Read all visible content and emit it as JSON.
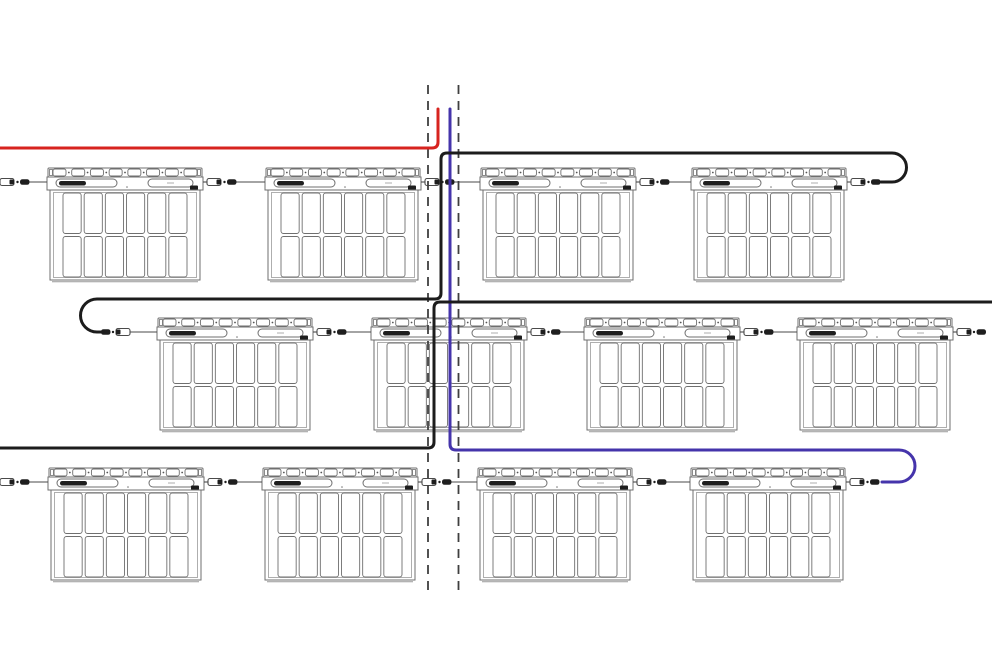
{
  "diagram": {
    "type": "solar-pv-string-wiring-diagram",
    "canvas": {
      "width": 992,
      "height": 650,
      "background": "#ffffff"
    },
    "row_count": 3,
    "panels_per_row": 4,
    "panel_count": 12,
    "colors": {
      "positive_wire_red": "#d7231f",
      "negative_wire_blue": "#4534ab",
      "string_wire_black": "#1c1c1c",
      "panel_outline": "#6f6f6f",
      "panel_outline_light": "#9a9a9a",
      "dark_fill": "#1e1e1e",
      "connector_line": "#4a4a4a",
      "guide_dash": "#3f3f3f"
    },
    "panel": {
      "w": 156,
      "h": 112,
      "rail": {
        "h": 9,
        "tabs": 8,
        "tab_w": 13,
        "tab_h": 7
      },
      "band": {
        "y": 9,
        "h": 13,
        "left_pill": {
          "x": 9,
          "y": 11,
          "w": 61,
          "h": 8,
          "blob_x": 12,
          "blob_w": 27
        },
        "right_pill": {
          "x": 101,
          "y": 11,
          "w": 45,
          "h": 8
        },
        "dark_square": {
          "x": 143,
          "y": 17.5,
          "w": 8,
          "h": 4.5
        },
        "center_dot_x": 80
      },
      "body": {
        "x": 3,
        "y": 22,
        "w": 150,
        "h": 90,
        "inner_inset": 3.5
      },
      "grid": {
        "x": 16,
        "y": 25,
        "w": 124,
        "h": 84,
        "cols": 6,
        "rows": 2,
        "gap": 3,
        "radius": 2.5
      }
    },
    "panel_rows": [
      {
        "name": "row-top",
        "y": 168,
        "conn_y": 182,
        "xs": [
          47,
          265,
          480,
          691
        ]
      },
      {
        "name": "row-middle",
        "y": 318,
        "conn_y": 332,
        "xs": [
          157,
          371,
          584,
          797
        ]
      },
      {
        "name": "row-bottom",
        "y": 468,
        "conn_y": 482,
        "xs": [
          48,
          262,
          477,
          690
        ]
      }
    ],
    "guide_lines": {
      "xs": [
        428,
        458.5
      ],
      "y_start": 85,
      "y_end": 590,
      "dash_pattern": "9 7",
      "width": 1.8
    },
    "wires": [
      {
        "name": "positive-home-run-wire-red",
        "color_key": "positive_wire_red",
        "width": 3,
        "path": "M 0 148 H 432 Q 438 148 438 142 V 109"
      },
      {
        "name": "negative-home-run-wire-blue",
        "color_key": "negative_wire_blue",
        "width": 3,
        "path": "M 450 109 V 444 Q 450 450 456 450 H 899 A 16 16 0 0 1 899 482 H 882"
      },
      {
        "name": "string-wire-top-black",
        "color_key": "string_wire_black",
        "width": 3,
        "path": "M 881 182 H 892 A 14.5 14.5 0 0 0 892 153 H 447 Q 441 153 441 159 V 293 Q 441 299 435 299 H 97 A 16.5 16.5 0 0 0 97 332 H 103"
      },
      {
        "name": "string-wire-bottom-black",
        "color_key": "string_wire_black",
        "width": 3,
        "path": "M 992 302 H 440 Q 434 302 434 308 V 442 Q 434 448 428 448 H 0"
      }
    ],
    "connectors": [
      {
        "y": 182,
        "x1": -4,
        "x2": 47,
        "style": "std"
      },
      {
        "y": 182,
        "x1": 203,
        "x2": 265,
        "style": "std"
      },
      {
        "y": 182,
        "x1": 421,
        "x2": 480,
        "style": "std"
      },
      {
        "y": 182,
        "x1": 636,
        "x2": 691,
        "style": "std"
      },
      {
        "y": 182,
        "x1": 847,
        "style": "cable-end-right"
      },
      {
        "y": 332,
        "x2": 157,
        "style": "cable-end-left"
      },
      {
        "y": 332,
        "x1": 313,
        "x2": 371,
        "style": "std"
      },
      {
        "y": 332,
        "x1": 527,
        "x2": 584,
        "style": "std"
      },
      {
        "y": 332,
        "x1": 740,
        "x2": 797,
        "style": "std"
      },
      {
        "y": 332,
        "x1": 953,
        "x2": 992,
        "style": "edge-right"
      },
      {
        "y": 482,
        "x1": -4,
        "x2": 48,
        "style": "std"
      },
      {
        "y": 482,
        "x1": 204,
        "x2": 262,
        "style": "std"
      },
      {
        "y": 482,
        "x1": 418,
        "x2": 477,
        "style": "std"
      },
      {
        "y": 482,
        "x1": 633,
        "x2": 690,
        "style": "std"
      },
      {
        "y": 482,
        "x1": 846,
        "style": "cable-end-right"
      }
    ]
  }
}
